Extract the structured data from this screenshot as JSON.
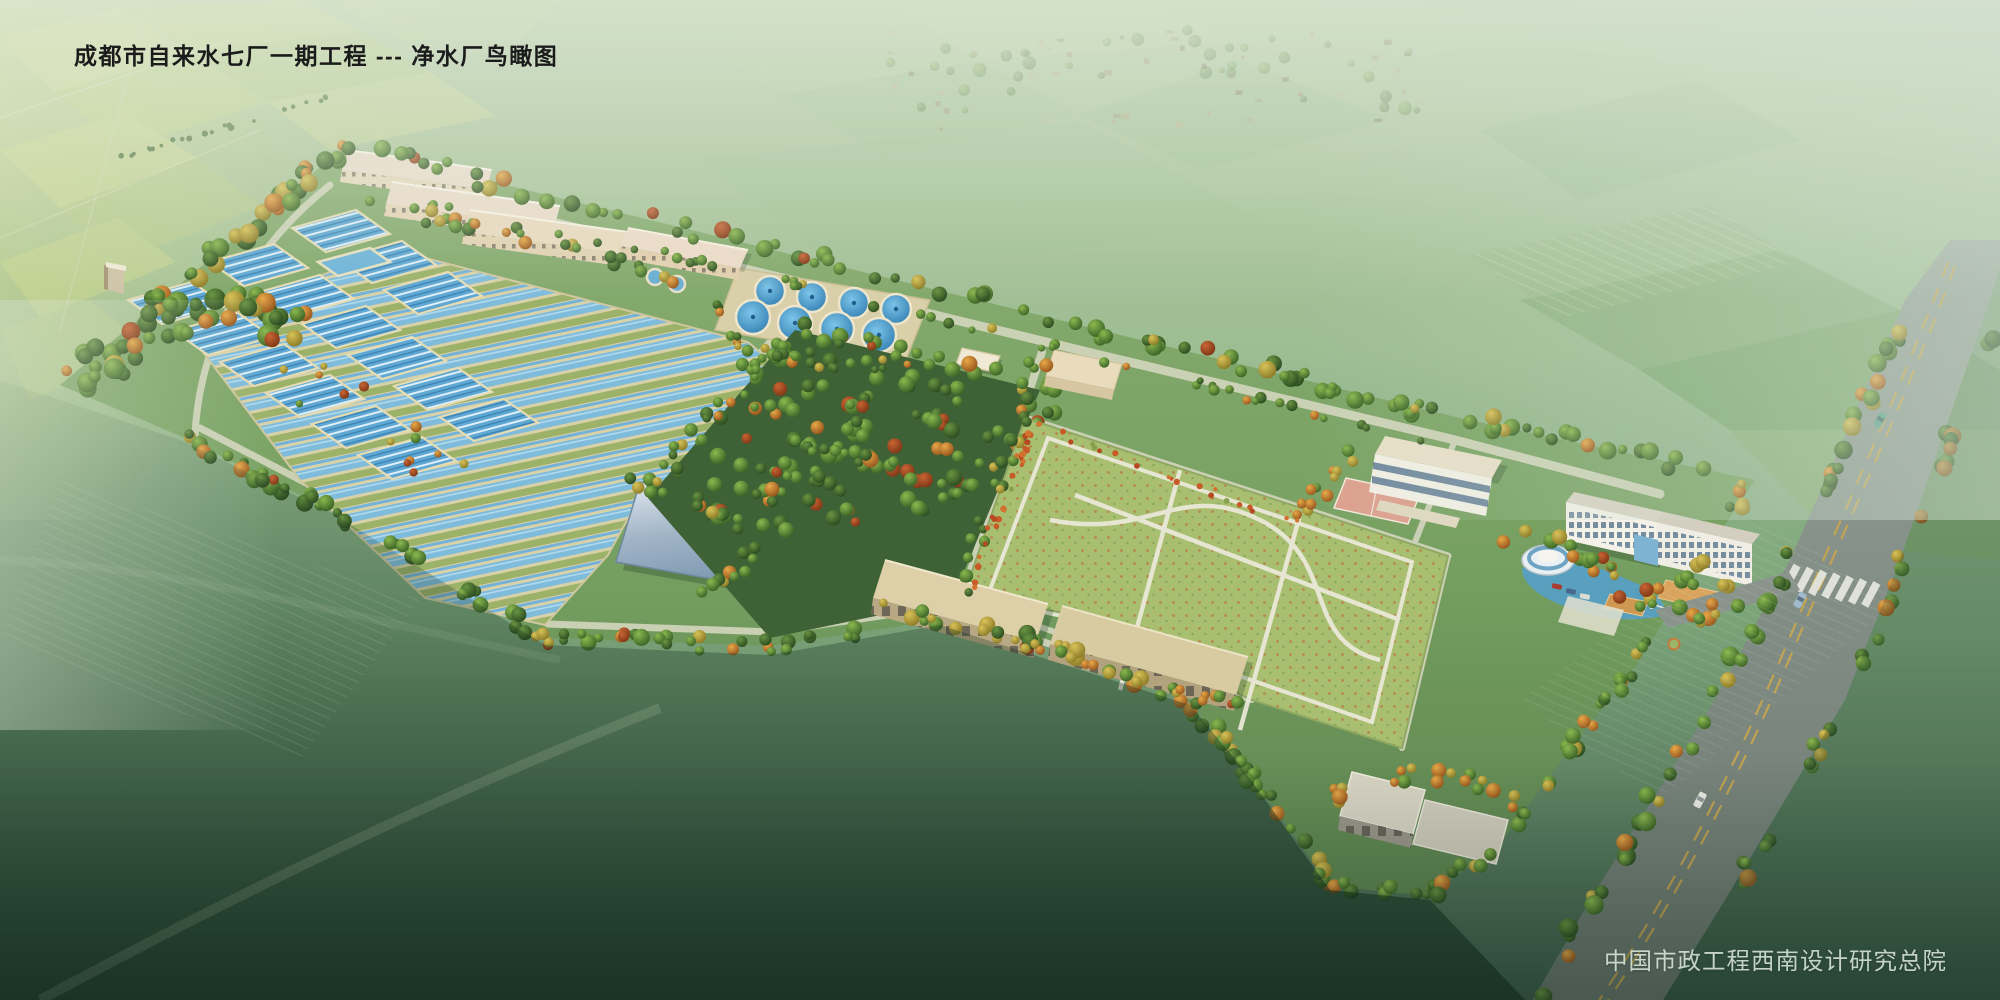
{
  "page": {
    "type": "architectural-aerial-rendering",
    "width_px": 2000,
    "height_px": 1000
  },
  "header": {
    "title": "成都市自来水七厂一期工程 --- 净水厂鸟瞰图"
  },
  "footer": {
    "credit": "中国市政工程西南设计研究总院"
  },
  "scene": {
    "subject": "water-treatment-plant-birds-eye-view",
    "elements": [
      "farmland-background",
      "distant-village",
      "plant-site",
      "tree-border",
      "sedimentation-basin-clusters",
      "long-filter-lanes",
      "intake-pool",
      "circular-clarifier-tanks",
      "north-office-buildings",
      "dosing-building",
      "filter-building-1",
      "filter-building-2",
      "backwash-building",
      "pavilion",
      "orchard",
      "lawn-garden",
      "basketball-court",
      "training-building",
      "garage-buildings",
      "south-workshop",
      "admin-office-building",
      "round-pavilion-building",
      "pond",
      "canopies",
      "parked-cars",
      "main-road",
      "crosswalk",
      "road-cars",
      "entrance-gate"
    ]
  },
  "colors": {
    "water_blue": "#6fb4d8",
    "clarifier_blue": "#3b8ec8",
    "lane_walkway": "#d9d1a8",
    "site_green": "#7aa065",
    "orchard_green": "#47683c",
    "lawn_green": "#a8bf72",
    "roof_beige_pink": "#e9d6c4",
    "filter_roof_blue": "#9fb2c6",
    "garage_roof": "#dcd0ab",
    "admin_white": "#f2f0e8",
    "road_gray": "#7d8a80",
    "road_line_yellow": "#c9a64d",
    "title_color": "#1b1b1b",
    "credit_color": "#dce8dc"
  }
}
